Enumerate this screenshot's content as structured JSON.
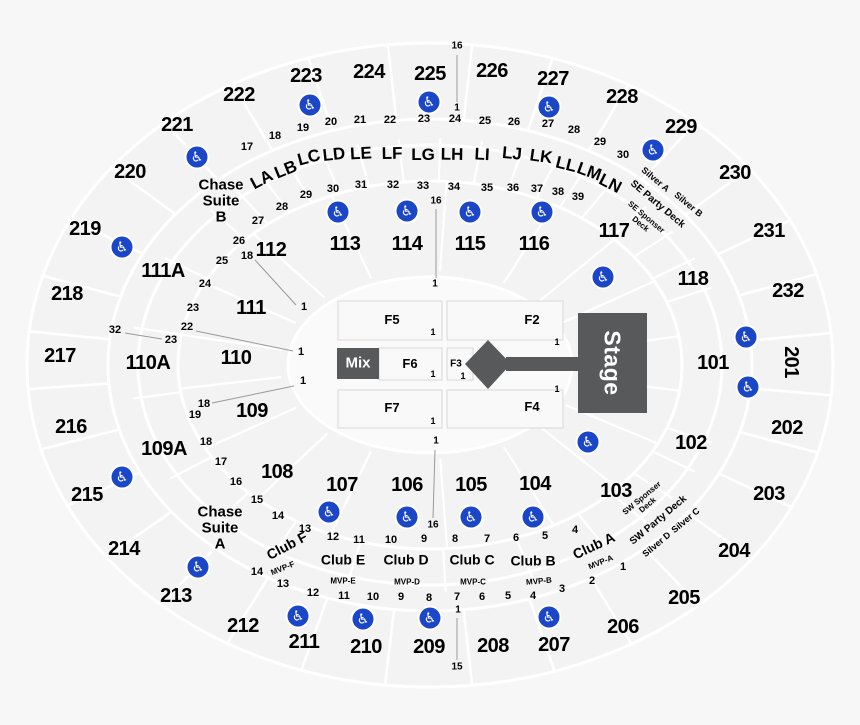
{
  "colors": {
    "background": "#f7f7f7",
    "section_fill": "#f3f3f4",
    "divider": "#ffffff",
    "floor_fill": "#fafafa",
    "floor_border": "#d8d8d8",
    "stage_gray": "#58595b",
    "wheelchair_blue": "#1b46c7",
    "leader_line": "#999999",
    "text": "#000000"
  },
  "stage": {
    "label": "Stage"
  },
  "mix": {
    "label": "Mix"
  },
  "sections_200": [
    {
      "t": "223",
      "x": 306,
      "y": 77
    },
    {
      "t": "224",
      "x": 369,
      "y": 73
    },
    {
      "t": "225",
      "x": 430,
      "y": 75
    },
    {
      "t": "226",
      "x": 492,
      "y": 72
    },
    {
      "t": "227",
      "x": 553,
      "y": 80
    },
    {
      "t": "222",
      "x": 239,
      "y": 96
    },
    {
      "t": "228",
      "x": 622,
      "y": 98
    },
    {
      "t": "221",
      "x": 177,
      "y": 126
    },
    {
      "t": "229",
      "x": 681,
      "y": 128
    },
    {
      "t": "220",
      "x": 130,
      "y": 173
    },
    {
      "t": "230",
      "x": 735,
      "y": 174
    },
    {
      "t": "219",
      "x": 85,
      "y": 230
    },
    {
      "t": "231",
      "x": 769,
      "y": 232
    },
    {
      "t": "218",
      "x": 67,
      "y": 295
    },
    {
      "t": "232",
      "x": 788,
      "y": 292
    },
    {
      "t": "217",
      "x": 60,
      "y": 357
    },
    {
      "t": "201",
      "x": 790,
      "y": 362,
      "r": 90
    },
    {
      "t": "216",
      "x": 71,
      "y": 428
    },
    {
      "t": "202",
      "x": 787,
      "y": 429
    },
    {
      "t": "215",
      "x": 87,
      "y": 496
    },
    {
      "t": "203",
      "x": 769,
      "y": 495
    },
    {
      "t": "214",
      "x": 124,
      "y": 550
    },
    {
      "t": "204",
      "x": 734,
      "y": 552
    },
    {
      "t": "213",
      "x": 176,
      "y": 597
    },
    {
      "t": "205",
      "x": 684,
      "y": 599
    },
    {
      "t": "212",
      "x": 243,
      "y": 627
    },
    {
      "t": "206",
      "x": 623,
      "y": 628
    },
    {
      "t": "211",
      "x": 304,
      "y": 643
    },
    {
      "t": "210",
      "x": 366,
      "y": 648
    },
    {
      "t": "209",
      "x": 429,
      "y": 648
    },
    {
      "t": "208",
      "x": 493,
      "y": 647
    },
    {
      "t": "207",
      "x": 554,
      "y": 646
    }
  ],
  "sections_100": [
    {
      "t": "112",
      "x": 271,
      "y": 251
    },
    {
      "t": "113",
      "x": 345,
      "y": 245
    },
    {
      "t": "114",
      "x": 407,
      "y": 245
    },
    {
      "t": "115",
      "x": 470,
      "y": 245
    },
    {
      "t": "116",
      "x": 534,
      "y": 245
    },
    {
      "t": "117",
      "x": 614,
      "y": 232
    },
    {
      "t": "118",
      "x": 693,
      "y": 280
    },
    {
      "t": "101",
      "x": 713,
      "y": 364
    },
    {
      "t": "102",
      "x": 691,
      "y": 444
    },
    {
      "t": "103",
      "x": 616,
      "y": 492
    },
    {
      "t": "104",
      "x": 535,
      "y": 485
    },
    {
      "t": "105",
      "x": 471,
      "y": 486
    },
    {
      "t": "106",
      "x": 407,
      "y": 486
    },
    {
      "t": "107",
      "x": 342,
      "y": 486
    },
    {
      "t": "108",
      "x": 277,
      "y": 473
    },
    {
      "t": "109",
      "x": 252,
      "y": 412
    },
    {
      "t": "110",
      "x": 236,
      "y": 359
    },
    {
      "t": "111",
      "x": 251,
      "y": 309
    },
    {
      "t": "111A",
      "x": 163,
      "y": 272
    },
    {
      "t": "110A",
      "x": 148,
      "y": 364
    },
    {
      "t": "109A",
      "x": 164,
      "y": 450
    }
  ],
  "letter_rows": [
    {
      "t": "LA",
      "x": 262,
      "y": 180,
      "r": -28
    },
    {
      "t": "LB",
      "x": 286,
      "y": 170,
      "r": -22
    },
    {
      "t": "LC",
      "x": 309,
      "y": 158,
      "r": -15
    },
    {
      "t": "LD",
      "x": 334,
      "y": 155,
      "r": -6
    },
    {
      "t": "LE",
      "x": 361,
      "y": 154,
      "r": -3
    },
    {
      "t": "LF",
      "x": 392,
      "y": 154,
      "r": -1
    },
    {
      "t": "LG",
      "x": 423,
      "y": 155
    },
    {
      "t": "LH",
      "x": 452,
      "y": 155,
      "r": 1
    },
    {
      "t": "LI",
      "x": 482,
      "y": 155,
      "r": 3
    },
    {
      "t": "LJ",
      "x": 512,
      "y": 154,
      "r": 5
    },
    {
      "t": "LK",
      "x": 541,
      "y": 157,
      "r": 8
    },
    {
      "t": "LL",
      "x": 566,
      "y": 165,
      "r": 14
    },
    {
      "t": "LM",
      "x": 589,
      "y": 172,
      "r": 20
    },
    {
      "t": "LN",
      "x": 610,
      "y": 184,
      "r": 27
    }
  ],
  "row_numbers": [
    {
      "t": "17",
      "x": 247,
      "y": 148
    },
    {
      "t": "18",
      "x": 275,
      "y": 137
    },
    {
      "t": "19",
      "x": 303,
      "y": 129
    },
    {
      "t": "20",
      "x": 331,
      "y": 123
    },
    {
      "t": "21",
      "x": 360,
      "y": 121
    },
    {
      "t": "22",
      "x": 390,
      "y": 121
    },
    {
      "t": "23",
      "x": 424,
      "y": 120
    },
    {
      "t": "24",
      "x": 455,
      "y": 120
    },
    {
      "t": "25",
      "x": 485,
      "y": 122
    },
    {
      "t": "26",
      "x": 514,
      "y": 123
    },
    {
      "t": "27",
      "x": 548,
      "y": 125
    },
    {
      "t": "28",
      "x": 574,
      "y": 131
    },
    {
      "t": "29",
      "x": 600,
      "y": 143
    },
    {
      "t": "30",
      "x": 623,
      "y": 156
    },
    {
      "t": "27",
      "x": 258,
      "y": 222
    },
    {
      "t": "28",
      "x": 282,
      "y": 208
    },
    {
      "t": "29",
      "x": 306,
      "y": 196
    },
    {
      "t": "30",
      "x": 333,
      "y": 190
    },
    {
      "t": "31",
      "x": 361,
      "y": 186
    },
    {
      "t": "32",
      "x": 393,
      "y": 186
    },
    {
      "t": "33",
      "x": 423,
      "y": 187
    },
    {
      "t": "34",
      "x": 454,
      "y": 188
    },
    {
      "t": "35",
      "x": 487,
      "y": 189
    },
    {
      "t": "36",
      "x": 513,
      "y": 189
    },
    {
      "t": "37",
      "x": 537,
      "y": 190
    },
    {
      "t": "38",
      "x": 558,
      "y": 193
    },
    {
      "t": "39",
      "x": 578,
      "y": 198
    },
    {
      "t": "26",
      "x": 239,
      "y": 242
    },
    {
      "t": "25",
      "x": 222,
      "y": 262
    },
    {
      "t": "24",
      "x": 205,
      "y": 285
    },
    {
      "t": "23",
      "x": 193,
      "y": 309
    },
    {
      "t": "22",
      "x": 187,
      "y": 328
    },
    {
      "t": "23",
      "x": 171,
      "y": 341
    },
    {
      "t": "32",
      "x": 115,
      "y": 331
    },
    {
      "t": "18",
      "x": 247,
      "y": 257
    },
    {
      "t": "18",
      "x": 204,
      "y": 405
    },
    {
      "t": "19",
      "x": 195,
      "y": 416
    },
    {
      "t": "18",
      "x": 206,
      "y": 443
    },
    {
      "t": "17",
      "x": 221,
      "y": 463
    },
    {
      "t": "16",
      "x": 236,
      "y": 483
    },
    {
      "t": "15",
      "x": 257,
      "y": 501
    },
    {
      "t": "14",
      "x": 278,
      "y": 517
    },
    {
      "t": "13",
      "x": 305,
      "y": 530
    },
    {
      "t": "12",
      "x": 333,
      "y": 538
    },
    {
      "t": "11",
      "x": 359,
      "y": 541
    },
    {
      "t": "10",
      "x": 391,
      "y": 541
    },
    {
      "t": "9",
      "x": 424,
      "y": 540
    },
    {
      "t": "8",
      "x": 455,
      "y": 540
    },
    {
      "t": "7",
      "x": 487,
      "y": 540
    },
    {
      "t": "6",
      "x": 516,
      "y": 539
    },
    {
      "t": "5",
      "x": 545,
      "y": 537
    },
    {
      "t": "4",
      "x": 575,
      "y": 531
    },
    {
      "t": "14",
      "x": 257,
      "y": 573
    },
    {
      "t": "13",
      "x": 283,
      "y": 585
    },
    {
      "t": "12",
      "x": 313,
      "y": 594
    },
    {
      "t": "11",
      "x": 344,
      "y": 597
    },
    {
      "t": "10",
      "x": 373,
      "y": 598
    },
    {
      "t": "9",
      "x": 401,
      "y": 598
    },
    {
      "t": "8",
      "x": 429,
      "y": 599
    },
    {
      "t": "7",
      "x": 457,
      "y": 598
    },
    {
      "t": "6",
      "x": 482,
      "y": 598
    },
    {
      "t": "5",
      "x": 508,
      "y": 597
    },
    {
      "t": "4",
      "x": 533,
      "y": 597
    },
    {
      "t": "3",
      "x": 562,
      "y": 590
    },
    {
      "t": "2",
      "x": 592,
      "y": 582
    },
    {
      "t": "1",
      "x": 623,
      "y": 568
    },
    {
      "t": "1",
      "x": 304,
      "y": 308
    },
    {
      "t": "1",
      "x": 301,
      "y": 353
    },
    {
      "t": "1",
      "x": 303,
      "y": 382
    }
  ],
  "line_markers": [
    {
      "t": "16",
      "x": 457,
      "y": 47
    },
    {
      "t": "1",
      "x": 457,
      "y": 109
    },
    {
      "t": "16",
      "x": 436,
      "y": 202
    },
    {
      "t": "1",
      "x": 435,
      "y": 285
    },
    {
      "t": "1",
      "x": 436,
      "y": 442
    },
    {
      "t": "16",
      "x": 433,
      "y": 526
    },
    {
      "t": "1",
      "x": 458,
      "y": 611
    },
    {
      "t": "15",
      "x": 457,
      "y": 668
    }
  ],
  "suites": [
    {
      "t": "Chase\nSuite\nB",
      "x": 221,
      "y": 202,
      "n": "suite-chase-suite-b"
    },
    {
      "t": "Chase\nSuite\nA",
      "x": 220,
      "y": 529,
      "n": "suite-chase-suite-a"
    }
  ],
  "clubs": [
    {
      "t": "Club F",
      "x": 287,
      "y": 546,
      "r": -28
    },
    {
      "t": "Club E",
      "x": 343,
      "y": 560
    },
    {
      "t": "Club D",
      "x": 406,
      "y": 560
    },
    {
      "t": "Club C",
      "x": 472,
      "y": 560
    },
    {
      "t": "Club B",
      "x": 533,
      "y": 561
    },
    {
      "t": "Club A",
      "x": 594,
      "y": 546,
      "r": -25
    }
  ],
  "mvp_rows": [
    {
      "t": "MVP-F",
      "x": 283,
      "y": 569,
      "r": -22
    },
    {
      "t": "MVP-E",
      "x": 343,
      "y": 582
    },
    {
      "t": "MVP-D",
      "x": 407,
      "y": 583
    },
    {
      "t": "MVP-C",
      "x": 473,
      "y": 583
    },
    {
      "t": "MVP-B",
      "x": 539,
      "y": 582,
      "r": -5
    },
    {
      "t": "MVP-A",
      "x": 601,
      "y": 563,
      "r": -22
    }
  ],
  "deck_labels": [
    {
      "t": "Silver A",
      "x": 655,
      "y": 180,
      "r": 40,
      "c": "silver",
      "n": "deck-silver-a"
    },
    {
      "t": "Silver B",
      "x": 688,
      "y": 205,
      "r": 40,
      "c": "silver",
      "n": "deck-silver-b"
    },
    {
      "t": "SE Party Deck",
      "x": 657,
      "y": 205,
      "r": 40,
      "c": "deck",
      "n": "deck-se-party-deck"
    },
    {
      "t": "SE Sponser\nDeck",
      "x": 643,
      "y": 221,
      "r": 40,
      "c": "decksm",
      "n": "deck-se-sponser-deck"
    },
    {
      "t": "SW Sponser\nDeck",
      "x": 645,
      "y": 502,
      "r": -40,
      "c": "decksm",
      "n": "deck-sw-sponser-deck"
    },
    {
      "t": "SW Party Deck",
      "x": 659,
      "y": 521,
      "r": -40,
      "c": "deck",
      "n": "deck-sw-party-deck"
    },
    {
      "t": "Silver D",
      "x": 657,
      "y": 545,
      "r": -40,
      "c": "silver",
      "n": "deck-silver-d"
    },
    {
      "t": "Silver C",
      "x": 686,
      "y": 521,
      "r": -40,
      "c": "silver",
      "n": "deck-silver-c"
    }
  ],
  "floor_labels": [
    {
      "t": "F5",
      "x": 392,
      "y": 320
    },
    {
      "t": "F2",
      "x": 532,
      "y": 320
    },
    {
      "t": "F6",
      "x": 410,
      "y": 364
    },
    {
      "t": "F3",
      "x": 456,
      "y": 365,
      "c": "f3"
    },
    {
      "t": "F7",
      "x": 392,
      "y": 408
    },
    {
      "t": "F4",
      "x": 532,
      "y": 407
    }
  ],
  "floor_ones": [
    {
      "t": "1",
      "x": 433,
      "y": 333
    },
    {
      "t": "1",
      "x": 557,
      "y": 343
    },
    {
      "t": "1",
      "x": 433,
      "y": 375
    },
    {
      "t": "1",
      "x": 463,
      "y": 377
    },
    {
      "t": "1",
      "x": 433,
      "y": 422
    },
    {
      "t": "1",
      "x": 557,
      "y": 390
    }
  ],
  "leader_lines": [
    {
      "x1": 457,
      "y1": 55,
      "x2": 457,
      "y2": 102
    },
    {
      "x1": 436,
      "y1": 209,
      "x2": 436,
      "y2": 278
    },
    {
      "x1": 435,
      "y1": 450,
      "x2": 433,
      "y2": 518
    },
    {
      "x1": 457,
      "y1": 618,
      "x2": 457,
      "y2": 660
    },
    {
      "x1": 125,
      "y1": 333,
      "x2": 162,
      "y2": 339
    },
    {
      "x1": 196,
      "y1": 331,
      "x2": 293,
      "y2": 351
    },
    {
      "x1": 255,
      "y1": 260,
      "x2": 296,
      "y2": 305
    },
    {
      "x1": 212,
      "y1": 403,
      "x2": 294,
      "y2": 386
    }
  ],
  "wheelchair_icons": [
    {
      "x": 310,
      "y": 105
    },
    {
      "x": 429,
      "y": 102
    },
    {
      "x": 549,
      "y": 107
    },
    {
      "x": 197,
      "y": 157
    },
    {
      "x": 653,
      "y": 150
    },
    {
      "x": 122,
      "y": 247
    },
    {
      "x": 338,
      "y": 212
    },
    {
      "x": 407,
      "y": 211
    },
    {
      "x": 470,
      "y": 212
    },
    {
      "x": 542,
      "y": 212
    },
    {
      "x": 603,
      "y": 277
    },
    {
      "x": 746,
      "y": 337
    },
    {
      "x": 748,
      "y": 387
    },
    {
      "x": 588,
      "y": 442
    },
    {
      "x": 122,
      "y": 477
    },
    {
      "x": 329,
      "y": 512
    },
    {
      "x": 407,
      "y": 517
    },
    {
      "x": 471,
      "y": 517
    },
    {
      "x": 533,
      "y": 517
    },
    {
      "x": 198,
      "y": 567
    },
    {
      "x": 298,
      "y": 616
    },
    {
      "x": 363,
      "y": 619
    },
    {
      "x": 430,
      "y": 618
    },
    {
      "x": 549,
      "y": 617
    }
  ]
}
